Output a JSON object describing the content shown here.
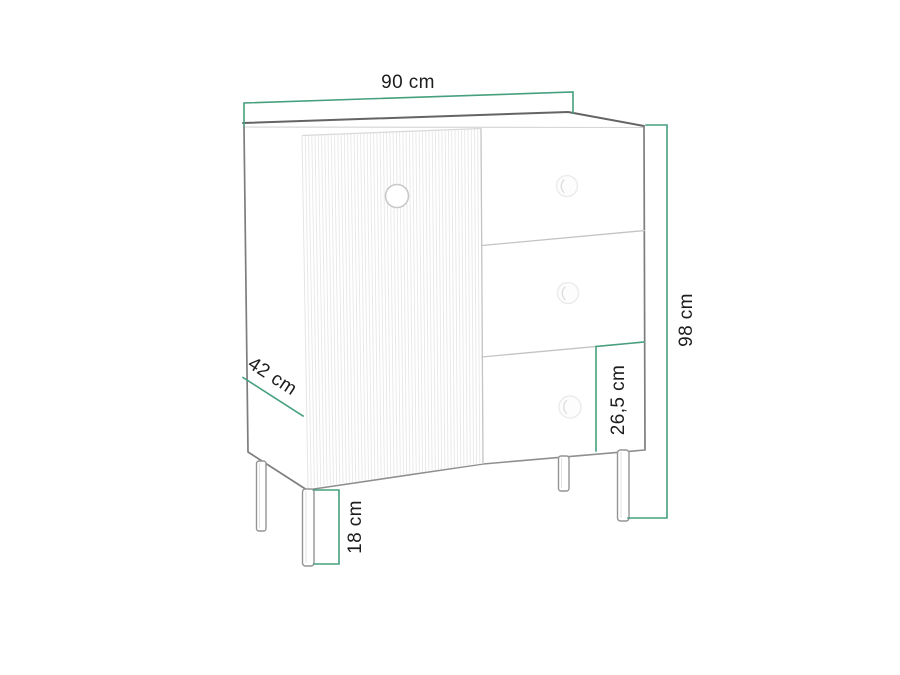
{
  "diagram": {
    "kind": "furniture dimension drawing",
    "subject": "sideboard with fluted left door, three right drawers and four legs",
    "labels": {
      "width": "90 cm",
      "height": "98 cm",
      "depth": "42 cm",
      "drawer_height": "26,5 cm",
      "leg_height": "18 cm"
    },
    "parts": {
      "door_count": 1,
      "drawer_count": 3,
      "leg_count": 4,
      "knob_count": 4
    },
    "door": {
      "flute_count": 55
    },
    "colors": {
      "dimension_line": "#46a07d",
      "label_text": "#1d1d1d",
      "outline_dark": "#646464",
      "outline_light": "#c9c9c9",
      "background": "#ffffff"
    }
  }
}
